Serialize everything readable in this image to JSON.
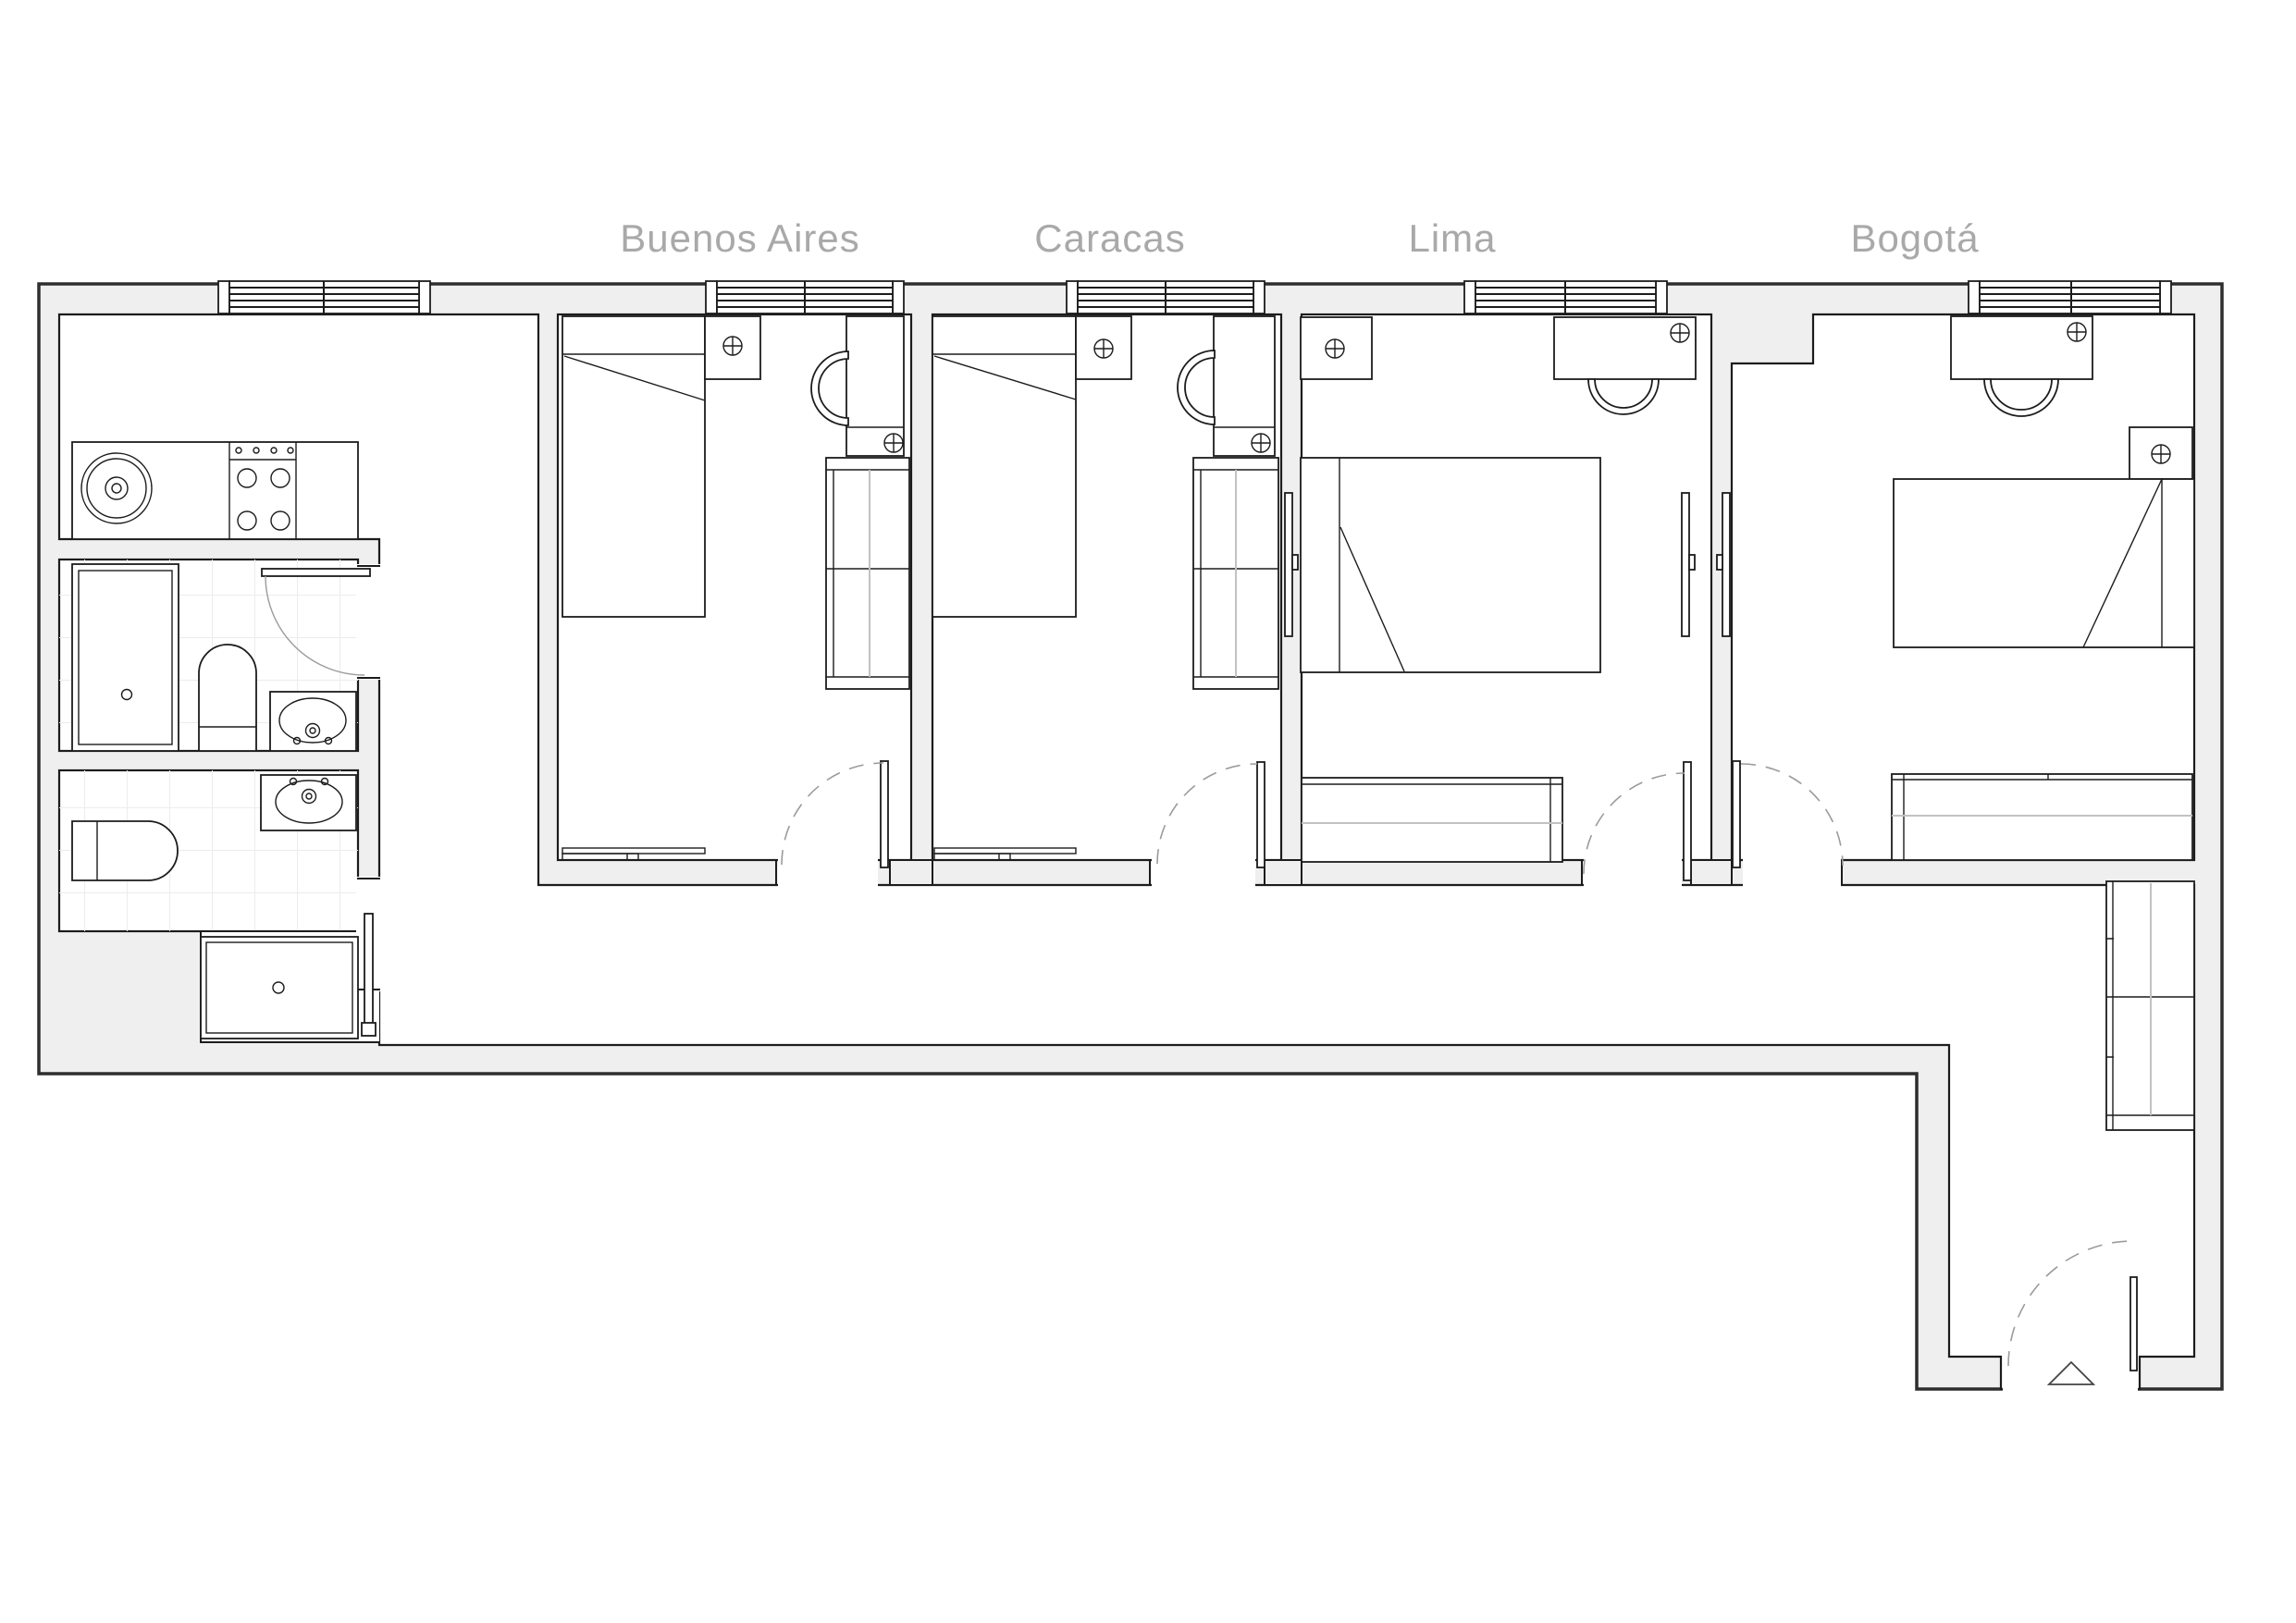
{
  "page": {
    "type": "apartment-floor-plan",
    "background": "#ffffff"
  },
  "rooms": [
    {
      "id": "buenos-aires",
      "label": "Buenos Aires",
      "furniture": [
        "single-bed",
        "nightstand",
        "light-point",
        "desk",
        "chair",
        "wardrobe",
        "sideboard",
        "window",
        "door"
      ]
    },
    {
      "id": "caracas",
      "label": "Caracas",
      "furniture": [
        "single-bed",
        "nightstand",
        "light-point",
        "desk",
        "chair",
        "wardrobe",
        "sideboard",
        "window",
        "door"
      ]
    },
    {
      "id": "lima",
      "label": "Lima",
      "furniture": [
        "double-bed",
        "nightstand",
        "light-point",
        "desk",
        "chair",
        "sideboard",
        "window",
        "door",
        "wall-panel"
      ]
    },
    {
      "id": "bogota",
      "label": "Bogotá",
      "furniture": [
        "double-bed",
        "nightstand",
        "light-point",
        "desk",
        "chair",
        "sideboard",
        "window",
        "door",
        "wall-panel"
      ]
    }
  ],
  "service_areas": {
    "kitchen": [
      "counter",
      "round-sink",
      "cooktop-4-burners"
    ],
    "bathroom_upper": [
      "shower-tray",
      "toilet",
      "washbasin",
      "hinged-door",
      "tiled-floor"
    ],
    "bathroom_lower": [
      "toilet",
      "washbasin",
      "sliding-door",
      "tiled-floor"
    ],
    "laundry_niche": [
      "washing-machine"
    ],
    "hallway": [
      "tall-cabinet"
    ],
    "entry": [
      "entrance-door",
      "door-swing",
      "entrance-marker-triangle"
    ]
  },
  "colors": {
    "wall_fill": "#efefef",
    "outer_line": "#2e2e2e",
    "line": "#1c1c1c",
    "light_line": "#c2c2c2",
    "tile_line": "#ececec",
    "swing_arc": "#9b9b9b",
    "label_text": "#a9a9a9",
    "floor": "#ffffff"
  }
}
